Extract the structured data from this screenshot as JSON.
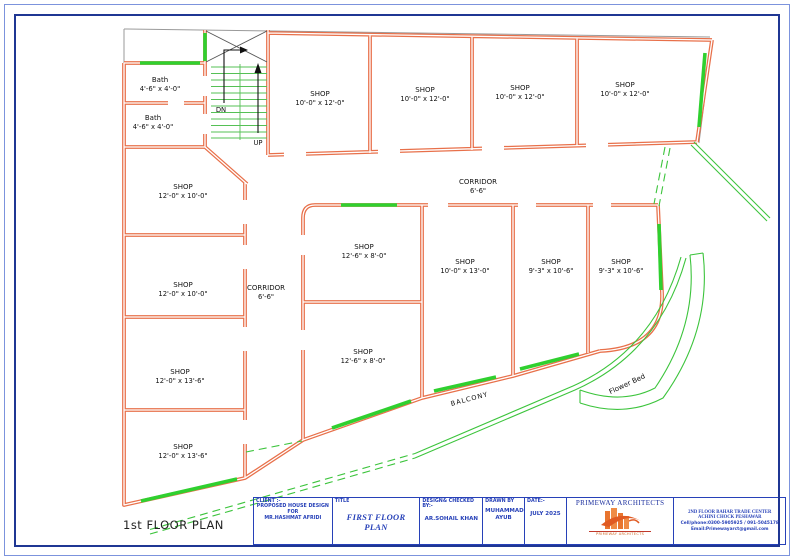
{
  "page": {
    "plan_label": "1st FLOOR PLAN"
  },
  "plan": {
    "rooms": [
      {
        "name": "Bath",
        "size": "4'-6\" x 4'-0\""
      },
      {
        "name": "Bath",
        "size": "4'-6\" x 4'-0\""
      },
      {
        "name": "SHOP",
        "size": "10'-0\" x 12'-0\""
      },
      {
        "name": "SHOP",
        "size": "10'-0\" x 12'-0\""
      },
      {
        "name": "SHOP",
        "size": "10'-0\" x 12'-0\""
      },
      {
        "name": "SHOP",
        "size": "10'-0\" x 12'-0\""
      },
      {
        "name": "SHOP",
        "size": "12'-0\" x 10'-0\""
      },
      {
        "name": "SHOP",
        "size": "12'-0\" x 10'-0\""
      },
      {
        "name": "SHOP",
        "size": "12'-0\" x 13'-6\""
      },
      {
        "name": "SHOP",
        "size": "12'-0\" x 13'-6\""
      },
      {
        "name": "SHOP",
        "size": "12'-6\" x 8'-0\""
      },
      {
        "name": "SHOP",
        "size": "12'-6\" x 8'-0\""
      },
      {
        "name": "SHOP",
        "size": "10'-0\" x 13'-0\""
      },
      {
        "name": "SHOP",
        "size": "9'-3\" x 10'-6\""
      },
      {
        "name": "SHOP",
        "size": "9'-3\" x 10'-6\""
      }
    ],
    "corridors": [
      {
        "name": "CORRIDOR",
        "size": "6'-6\""
      },
      {
        "name": "CORRIDOR",
        "size": "6'-6\""
      }
    ],
    "stairs": {
      "down": "DN",
      "up": "UP"
    },
    "balcony_label": "BALCONY",
    "flower_bed_label": "Flower Bed"
  },
  "title_block": {
    "client_label": "CLIENT :-",
    "client_lines": [
      "PROPOSED HOUSE DESIGN",
      "FOR",
      "MR.HASHMAT AFRIDI"
    ],
    "title_label": "TITLE",
    "title_value": "FIRST FLOOR PLAN",
    "designed_label": "DESIGN& CHECKED BY:-",
    "designed_value": "AR.SOHAIL KHAN",
    "drawn_label": "DRAWN BY",
    "drawn_value_lines": [
      "MUHAMMAD",
      "AYUB"
    ],
    "date_label": "DATE:-",
    "date_value": "JULY 2025",
    "firm_name": "PRIMEWAY ARCHITECTS",
    "firm_logo_caption": "PRIMEWAY ARCHITECTS",
    "contact_lines": [
      "2ND FLOOR BAHAR TRADE CENTER",
      "ACHINI CHOCK PESHAWAR",
      "Cell/phone:0300-5905925 / 091-5045178",
      "Email:Primewayarct@gmail.com"
    ]
  },
  "colors": {
    "wall_orange": "#e8704a",
    "window_green": "#2fd02f",
    "landscape_green": "#55c055",
    "title_blue": "#2741b8",
    "border_outer": "#7c93dd",
    "border_inner": "#1f3693"
  }
}
